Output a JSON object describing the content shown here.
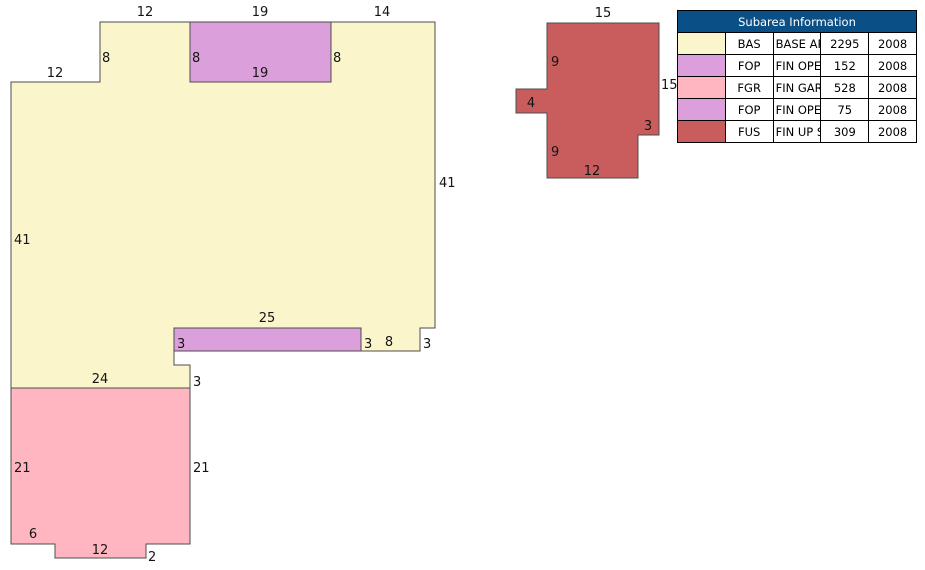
{
  "sketch": {
    "background": "#ffffff",
    "outline_color": "#4d4d4d",
    "label_color": "#141414",
    "label_font_size": 13,
    "shapes": [
      {
        "name": "base-area",
        "code": "BAS",
        "fill": "#FBF5CC",
        "points": "100,22 435,22 435,328 420,328 420,351 174,351 174,365 190,365 190,388 11,388 11,82 100,82"
      },
      {
        "name": "fin-open-porch-top",
        "code": "FOP",
        "fill": "#DBA0DB",
        "points": "190,22 331,22 331,82 190,82"
      },
      {
        "name": "fin-open-porch-mid",
        "code": "FOP",
        "fill": "#DBA0DB",
        "points": "174,328 361,328 361,351 174,351"
      },
      {
        "name": "fin-garage",
        "code": "FGR",
        "fill": "#FFB6C1",
        "points": "11,388 190,388 190,544 146,544 146,558 55,558 55,544 11,544"
      },
      {
        "name": "fin-up-story",
        "code": "FUS",
        "fill": "#C95D5D",
        "points": "547,23 659,23 659,135 638,135 638,178 547,178 547,113 516,113 516,89 547,89"
      }
    ],
    "labels": [
      {
        "text": "12",
        "x": 145,
        "y": 16,
        "anchor": "middle"
      },
      {
        "text": "19",
        "x": 260,
        "y": 16,
        "anchor": "middle"
      },
      {
        "text": "14",
        "x": 382,
        "y": 16,
        "anchor": "middle"
      },
      {
        "text": "8",
        "x": 102,
        "y": 62,
        "anchor": "start"
      },
      {
        "text": "12",
        "x": 55,
        "y": 77,
        "anchor": "middle"
      },
      {
        "text": "8",
        "x": 192,
        "y": 62,
        "anchor": "start"
      },
      {
        "text": "19",
        "x": 260,
        "y": 77,
        "anchor": "middle"
      },
      {
        "text": "8",
        "x": 333,
        "y": 62,
        "anchor": "start"
      },
      {
        "text": "41",
        "x": 439,
        "y": 187,
        "anchor": "start"
      },
      {
        "text": "41",
        "x": 14,
        "y": 244,
        "anchor": "start"
      },
      {
        "text": "25",
        "x": 267,
        "y": 322,
        "anchor": "middle"
      },
      {
        "text": "3",
        "x": 177,
        "y": 348,
        "anchor": "start"
      },
      {
        "text": "3",
        "x": 364,
        "y": 348,
        "anchor": "start"
      },
      {
        "text": "8",
        "x": 389,
        "y": 346,
        "anchor": "middle"
      },
      {
        "text": "3",
        "x": 423,
        "y": 348,
        "anchor": "start"
      },
      {
        "text": "24",
        "x": 100,
        "y": 383,
        "anchor": "middle"
      },
      {
        "text": "3",
        "x": 193,
        "y": 386,
        "anchor": "start"
      },
      {
        "text": "21",
        "x": 14,
        "y": 472,
        "anchor": "start"
      },
      {
        "text": "21",
        "x": 193,
        "y": 472,
        "anchor": "start"
      },
      {
        "text": "6",
        "x": 33,
        "y": 538,
        "anchor": "middle"
      },
      {
        "text": "12",
        "x": 100,
        "y": 554,
        "anchor": "middle"
      },
      {
        "text": "2",
        "x": 148,
        "y": 561,
        "anchor": "start"
      },
      {
        "text": "15",
        "x": 603,
        "y": 17,
        "anchor": "middle"
      },
      {
        "text": "9",
        "x": 551,
        "y": 66,
        "anchor": "start"
      },
      {
        "text": "4",
        "x": 531,
        "y": 107,
        "anchor": "middle"
      },
      {
        "text": "15",
        "x": 661,
        "y": 89,
        "anchor": "start"
      },
      {
        "text": "3",
        "x": 648,
        "y": 130,
        "anchor": "middle"
      },
      {
        "text": "9",
        "x": 551,
        "y": 156,
        "anchor": "start"
      },
      {
        "text": "12",
        "x": 592,
        "y": 175,
        "anchor": "middle"
      }
    ]
  },
  "table": {
    "title": "Subarea Information",
    "header_bg": "#0B4F87",
    "header_text_color": "#ffffff",
    "rows": [
      {
        "color": "#FBF5CC",
        "code": "BAS",
        "description": "BASE AREA",
        "area": "2295",
        "year": "2008"
      },
      {
        "color": "#DBA0DB",
        "code": "FOP",
        "description": "FIN OPEN PORCH",
        "area": "152",
        "year": "2008"
      },
      {
        "color": "#FFB6C1",
        "code": "FGR",
        "description": "FIN GARAGE",
        "area": "528",
        "year": "2008"
      },
      {
        "color": "#DBA0DB",
        "code": "FOP",
        "description": "FIN OPEN PORCH",
        "area": "75",
        "year": "2008"
      },
      {
        "color": "#C95D5D",
        "code": "FUS",
        "description": "FIN UP STORY",
        "area": "309",
        "year": "2008"
      }
    ]
  }
}
